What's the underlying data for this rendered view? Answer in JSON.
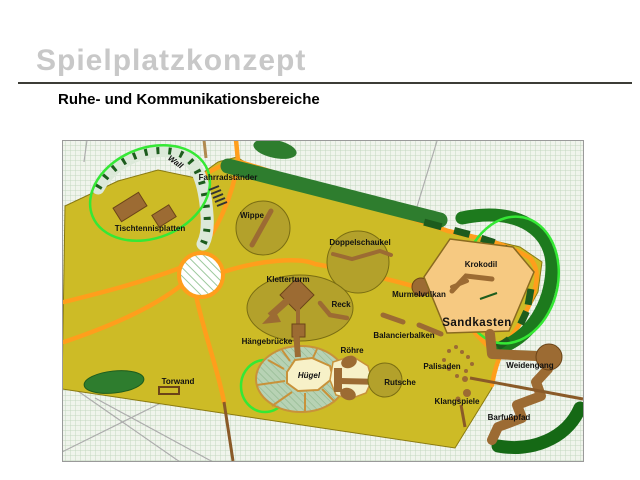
{
  "slide": {
    "title": "Spielplatzkonzept",
    "subtitle": "Ruhe- und Kommunikationsbereiche"
  },
  "map": {
    "labels": {
      "wall": "Wall",
      "fahrradstaender": "Fahrradständer",
      "tischtennisplatten": "Tischtennisplatten",
      "wippe": "Wippe",
      "doppelschaukel": "Doppelschaukel",
      "kletterturm": "Kletterturm",
      "reck": "Reck",
      "murmelvulkan": "Murmelvulkan",
      "krokodil": "Krokodil",
      "sandkasten": "Sandkasten",
      "balancierbalken": "Balancierbalken",
      "haengebruecke": "Hängebrücke",
      "roehre": "Röhre",
      "huegel": "Hügel",
      "rutsche": "Rutsche",
      "palisaden": "Palisaden",
      "weidengang": "Weidengang",
      "torwand": "Torwand",
      "klangspiele": "Klangspiele",
      "barfusspfad": "Barfußpfad"
    },
    "colors": {
      "ground": "#CDBB26",
      "feature_olive": "#B3A12B",
      "path_orange": "#FF9E1C",
      "hedge_green": "#2E7D2E",
      "hedge_dark": "#1D5C1D",
      "equipment_brown": "#9C6B33",
      "sand": "#F6C981",
      "cream": "#F7F1C8",
      "highlight_ellipse": "#35E835",
      "title_gray": "#C8C8C8"
    }
  }
}
